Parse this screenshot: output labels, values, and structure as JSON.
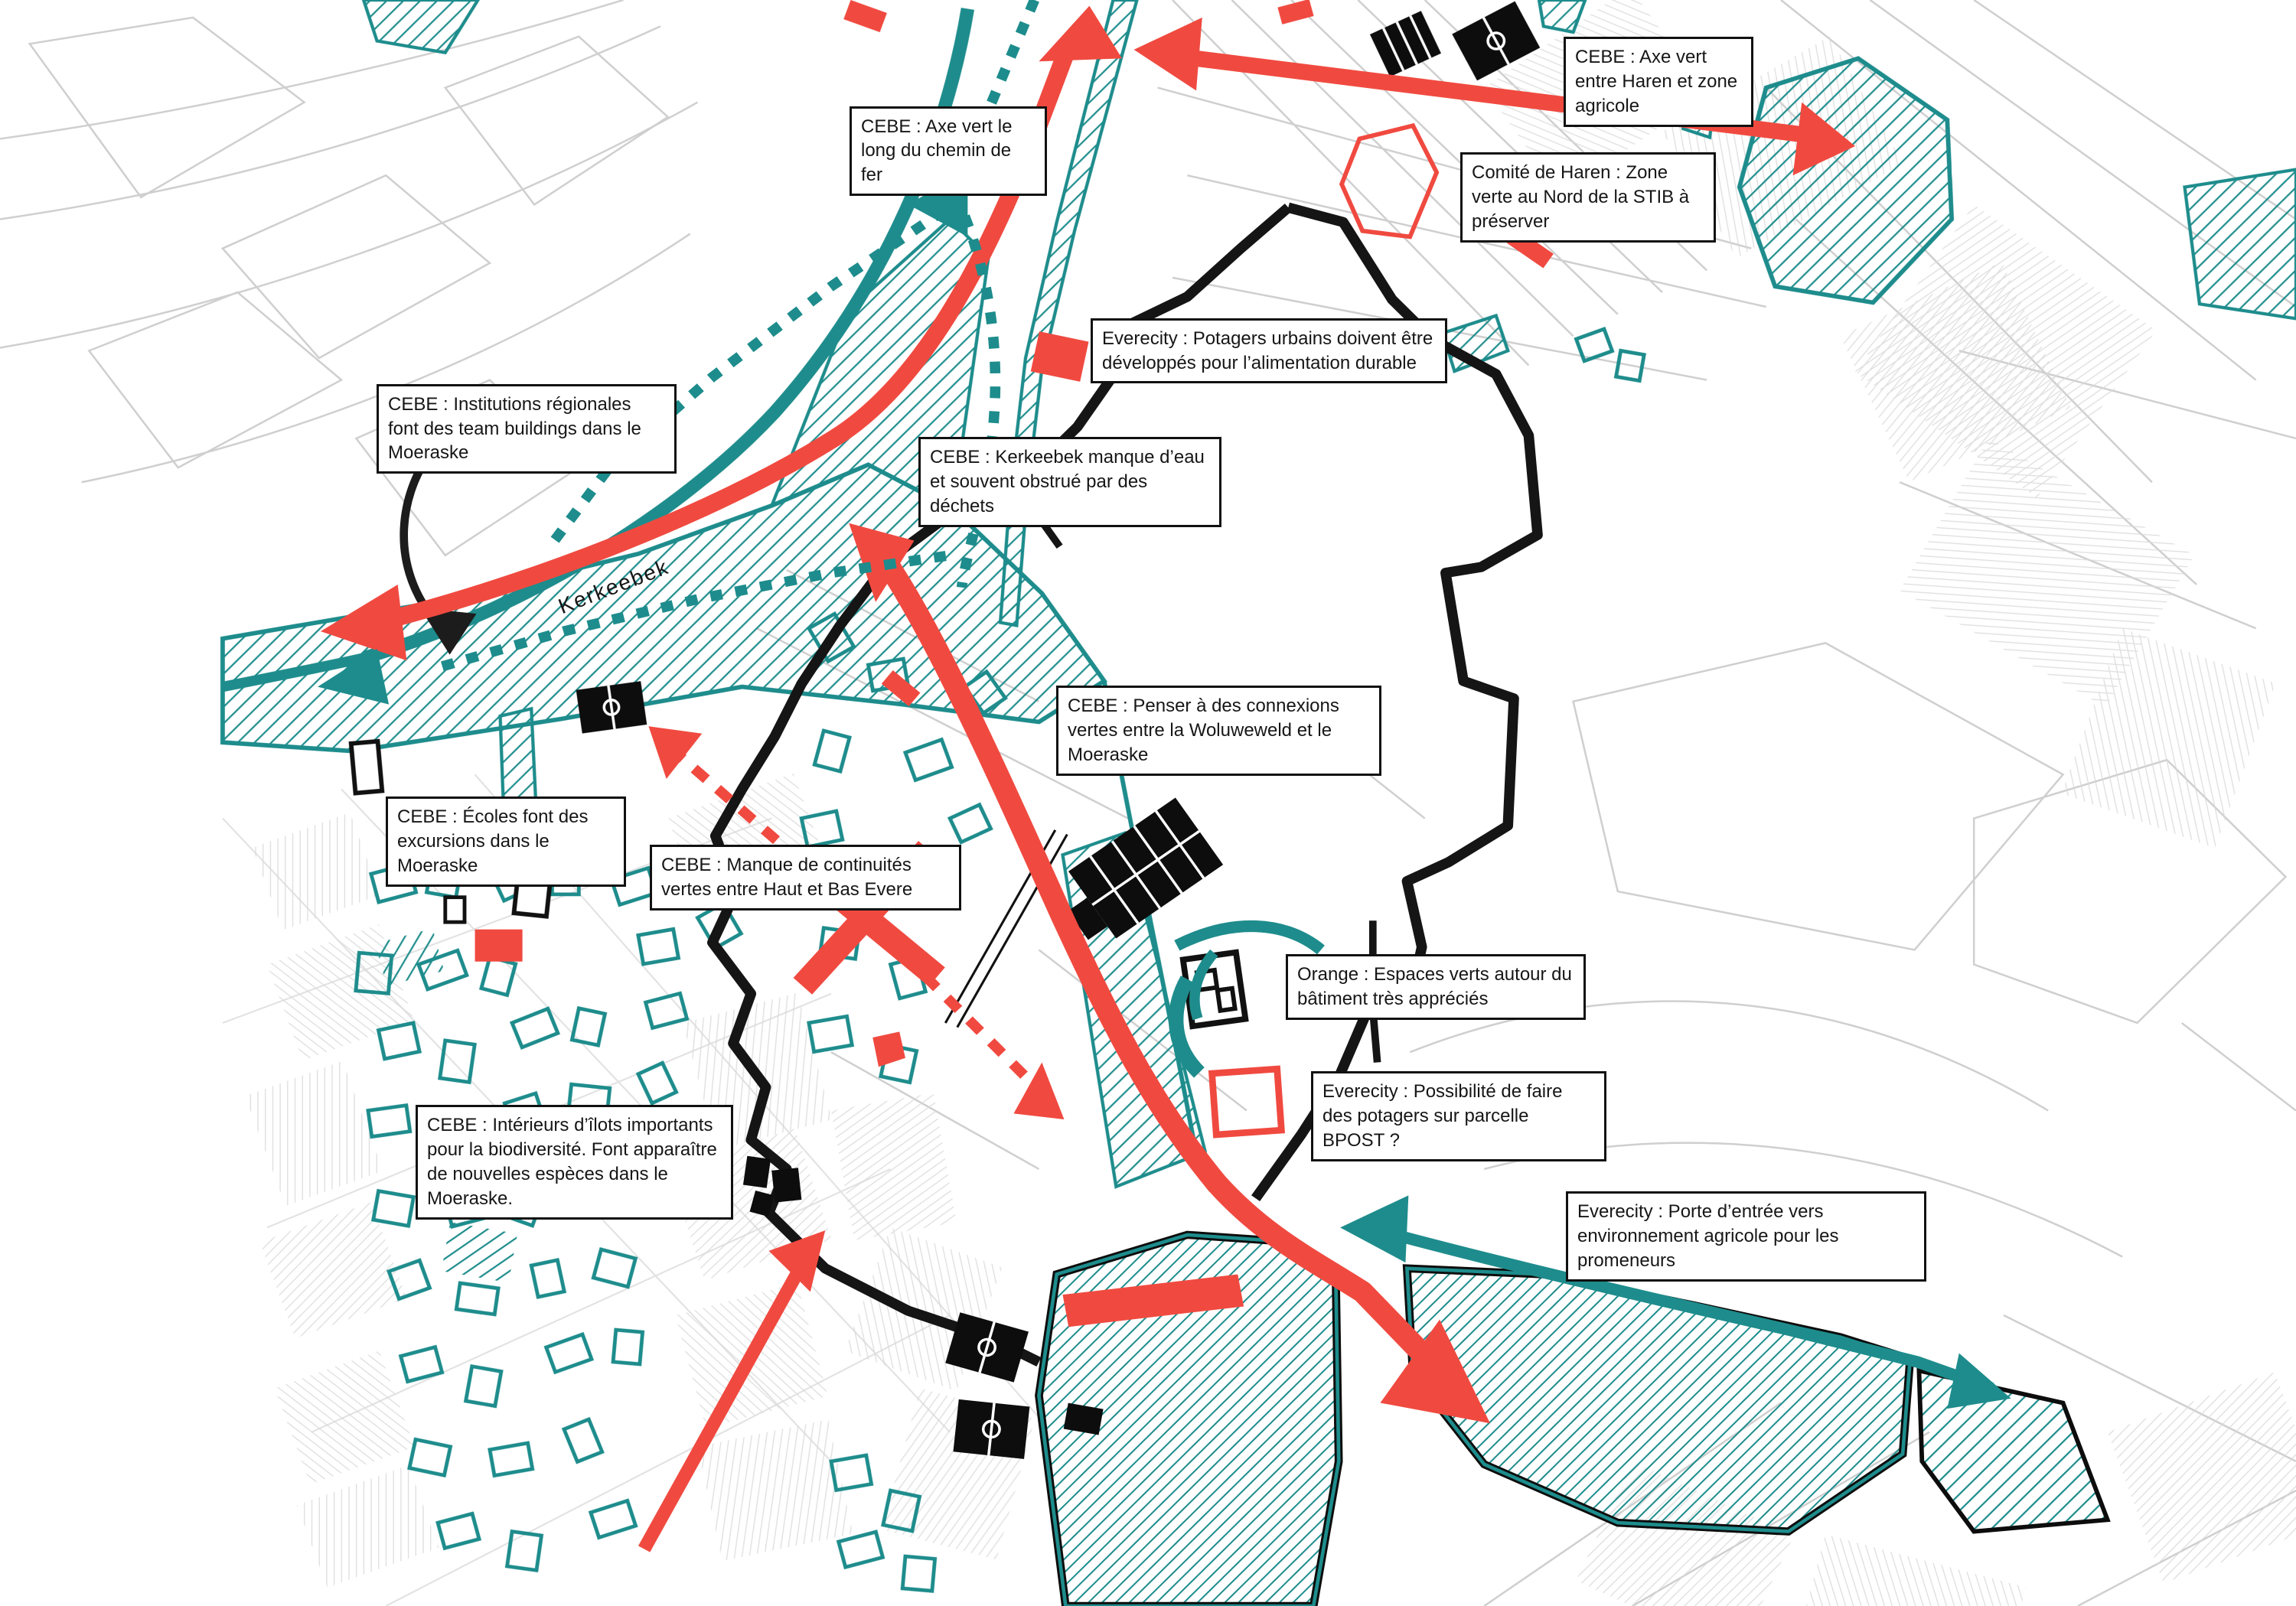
{
  "colors": {
    "teal": "#1e8c8c",
    "red": "#f04a40",
    "black": "#151515",
    "gray": "#cfcfcf",
    "label_border": "#111111",
    "label_bg": "#ffffff"
  },
  "map": {
    "stream_label": "Kerkeebek",
    "annotations": [
      {
        "id": "axe-vert-haren",
        "text": "CEBE : Axe vert entre Haren et zone agricole"
      },
      {
        "id": "axe-vert-chemin-de-fer",
        "text": "CEBE : Axe vert le long du chemin de fer"
      },
      {
        "id": "zone-verte-stib",
        "text": "Comité de Haren : Zone verte au Nord de la STIB à préserver"
      },
      {
        "id": "potagers-urbains",
        "text": "Everecity : Potagers urbains doivent être développés pour l’alimentation durable"
      },
      {
        "id": "team-buildings",
        "text": "CEBE :  Institutions régionales font des team buildings dans le Moeraske"
      },
      {
        "id": "kerkeebek-manque-eau",
        "text": "CEBE :  Kerkeebek manque d’eau et souvent obstrué par des déchets"
      },
      {
        "id": "connexions-vertes",
        "text": "CEBE :  Penser à des connexions vertes entre la Woluweweld et le Moeraske"
      },
      {
        "id": "ecoles-excursions",
        "text": "CEBE :  Écoles font des excursions dans le Moeraske"
      },
      {
        "id": "manque-continuites",
        "text": "CEBE : Manque de continuités vertes entre Haut et Bas Evere"
      },
      {
        "id": "espaces-verts-batiment",
        "text": "Orange :  Espaces verts autour du bâtiment très appréciés"
      },
      {
        "id": "potagers-bpost",
        "text": "Everecity : Possibilité de faire des potagers sur parcelle BPOST ?"
      },
      {
        "id": "interieurs-ilots",
        "text": "CEBE : Intérieurs d’îlots importants pour la biodiversité. Font apparaître de nouvelles espèces dans le Moeraske."
      },
      {
        "id": "porte-entree-agricole",
        "text": "Everecity : Porte d’entrée vers environnement agricole pour les promeneurs"
      }
    ]
  }
}
